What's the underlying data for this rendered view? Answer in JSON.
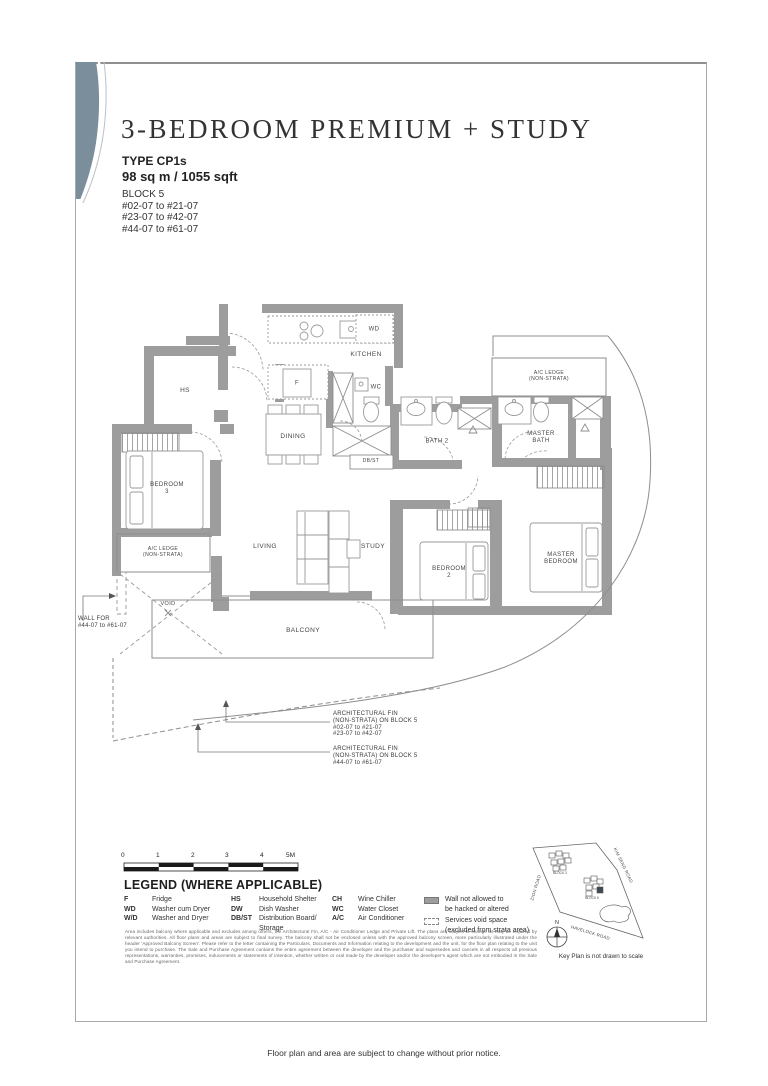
{
  "header": {
    "title": "3-BEDROOM PREMIUM + STUDY",
    "unit_type": "TYPE CP1s",
    "area": "98 sq m / 1055 sqft",
    "block": "BLOCK 5",
    "unit_ranges": [
      "#02-07 to #21-07",
      "#23-07 to #42-07",
      "#44-07 to #61-07"
    ]
  },
  "plan": {
    "labels": {
      "kitchen": "KITCHEN",
      "wd": "WD",
      "fridge": "F",
      "wc": "WC",
      "dining": "DINING",
      "dbst": "DB/ST",
      "hs": "HS",
      "bath2": "BATH 2",
      "master_bath": "MASTER\nBATH",
      "ac_ledge_top": "A/C LEDGE\n(NON-STRATA)",
      "bedroom3": "BEDROOM\n3",
      "ac_ledge_left": "A/C LEDGE\n(NON-STRATA)",
      "void": "VOID",
      "living": "LIVING",
      "study": "STUDY",
      "bedroom2": "BEDROOM\n2",
      "master_bedroom": "MASTER\nBEDROOM",
      "balcony": "BALCONY"
    },
    "notes": {
      "wall_note": "WALL FOR\n#44-07 to #61-07",
      "fin_note_upper": "ARCHITECTURAL FIN\n(NON-STRATA) ON BLOCK 5\n#02-07 to #21-07\n#23-07 to #42-07",
      "fin_note_lower": "ARCHITECTURAL FIN\n(NON-STRATA) ON BLOCK 5\n#44-07 to #61-07"
    }
  },
  "scale_bar": {
    "ticks": [
      "0",
      "1",
      "2",
      "3",
      "4",
      "5M"
    ]
  },
  "legend": {
    "heading": "LEGEND (WHERE APPLICABLE)",
    "items": [
      {
        "abbr": "F",
        "desc": "Fridge"
      },
      {
        "abbr": "WD",
        "desc": "Washer cum Dryer"
      },
      {
        "abbr": "W/D",
        "desc": "Washer and Dryer"
      },
      {
        "abbr": "HS",
        "desc": "Household Shelter"
      },
      {
        "abbr": "DW",
        "desc": "Dish Washer"
      },
      {
        "abbr": "DB/ST",
        "desc": "Distribution Board/\nStorage"
      },
      {
        "abbr": "CH",
        "desc": "Wine Chiller"
      },
      {
        "abbr": "WC",
        "desc": "Water Closet"
      },
      {
        "abbr": "A/C",
        "desc": "Air Conditioner"
      }
    ],
    "wall_item": "Wall not allowed to\nbe hacked or altered",
    "void_item": "Services void space\n(excluded from strata area)"
  },
  "disclaimer": "Area includes balcony where applicable and excludes among others, the Architectural Fin, A/C - Air Conditioner Ledge and Private Lift. The plans are subject to change as may be required by relevant authorities. All floor plans and areas are subject to final survey. The balcony shall not be enclosed unless with the approved balcony screen, more particularly illustrated under the header 'Approved Balcony Screen'. Please refer to the letter containing the Particulars, Documents and Information relating to the development and the unit, for the floor plan relating to the unit you intend to purchase. The Sale and Purchase Agreement contains the entire agreement between the developer and the purchaser and supersedes and cancels in all respects all previous representations, warranties, promises, inducements or statements of intention, whether written or oral made by the developer and/or the developer's agent which are not embodied in the Sale and Purchase Agreement.",
  "key_plan": {
    "roads": {
      "left": "ZION ROAD",
      "right": "KIM SENG ROAD",
      "bottom": "HAVELOCK ROAD"
    },
    "blocks": {
      "other": "BLOCK 3",
      "current": "BLOCK 5"
    },
    "compass": "N",
    "note": "Key Plan is not drawn to scale"
  },
  "footer": "Floor plan and area are subject to change without prior notice.",
  "colors": {
    "accent": "#7b8e9c",
    "wall": "#9d9d9d",
    "line": "#8e8e8e",
    "text": "#3c3c3c"
  }
}
